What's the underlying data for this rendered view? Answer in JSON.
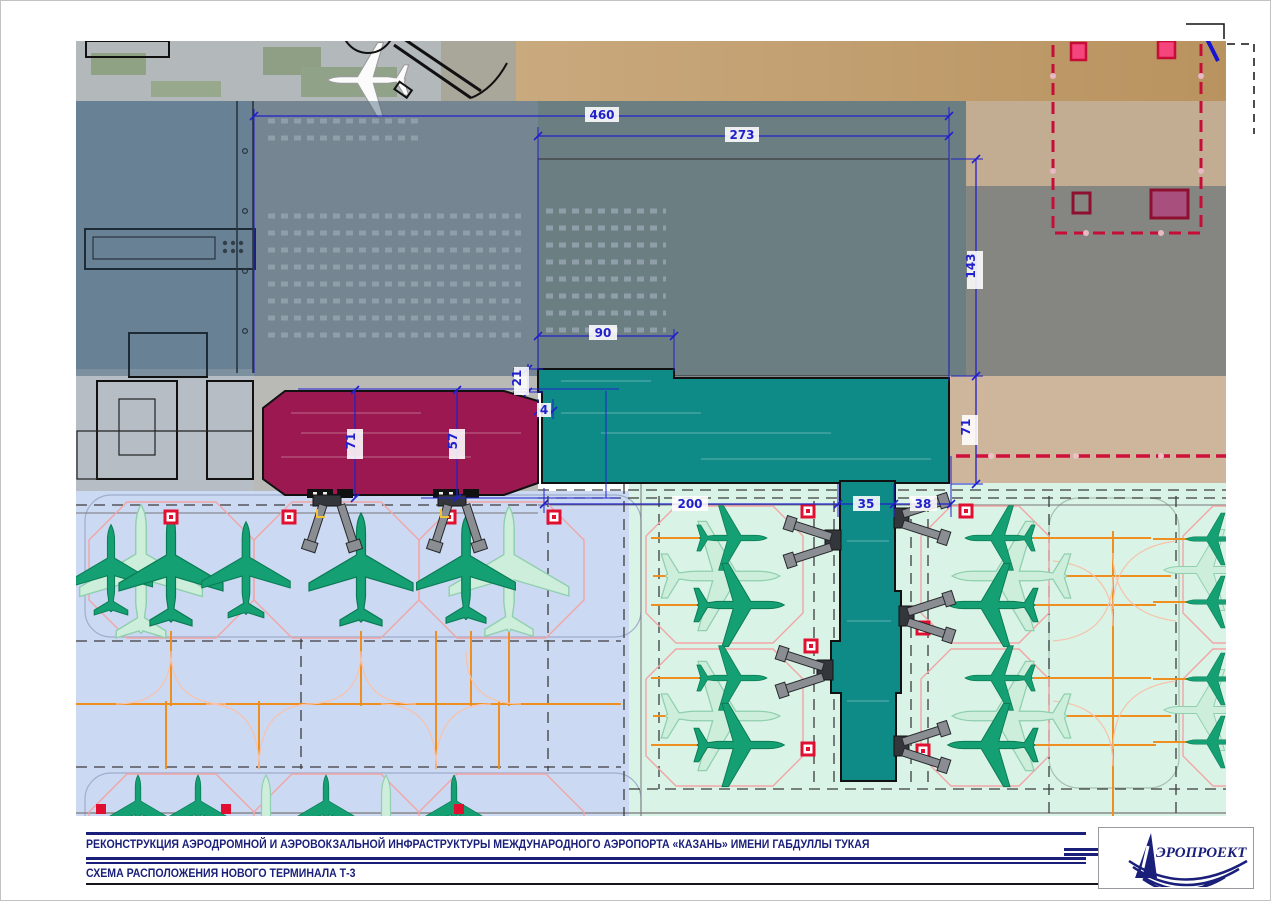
{
  "titleblock": {
    "line1": "РЕКОНСТРУКЦИЯ АЭРОДРОМНОЙ И АЭРОВОКЗАЛЬНОЙ ИНФРАСТРУКТУРЫ МЕЖДУНАРОДНОГО АЭРОПОРТА «КАЗАНЬ» ИМЕНИ ГАБДУЛЛЫ ТУКАЯ",
    "line2": "СХЕМА РАСПОЛОЖЕНИЯ НОВОГО ТЕРМИНАЛА Т-3",
    "logo": "ЭРОПРОЕКТ"
  },
  "dims": {
    "overall_width": "460",
    "planned_width": "273",
    "planned_depth": "143",
    "south_depth": "71",
    "notch_width": "90",
    "notch_depth": "21",
    "gap": "4",
    "apron_front": "200",
    "pier_width": "35",
    "taxilane_width": "38",
    "existing_depth": "71",
    "existing_hall_depth": "57"
  },
  "colors": {
    "dimension_blue": "#2121cc",
    "existing_terminal_magenta": "#9b1950",
    "new_terminal_teal": "#0e8a87",
    "apron_west_blue": "#ccd9f3",
    "apron_east_green": "#d9f4e7",
    "boundary_red": "#c60d38",
    "marker_red": "#e11031",
    "taxi_orange": "#ef8f1f",
    "stand_pink": "#f2a5a5",
    "aircraft_green": "#14a072",
    "title_navy": "#1a1f7a"
  }
}
